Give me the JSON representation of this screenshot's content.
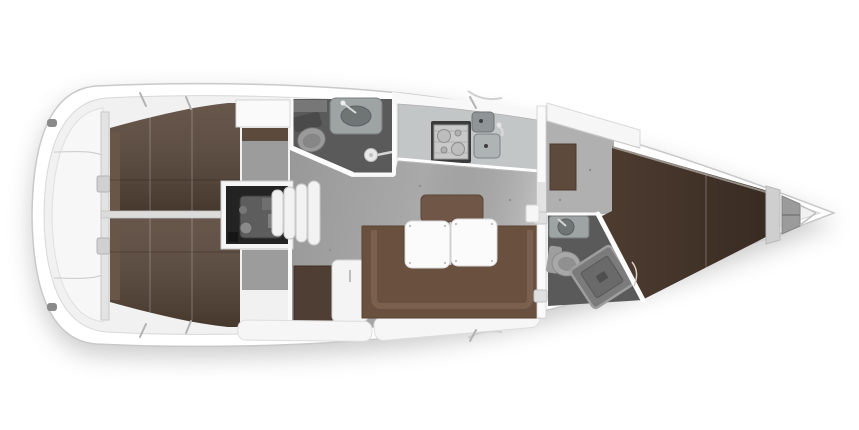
{
  "meta": {
    "type": "yacht-interior-floor-plan",
    "view": "top-down",
    "canvas": {
      "width": 859,
      "height": 430
    }
  },
  "parts": [
    "stern-lazarette",
    "aft-cabin-port-berth",
    "aft-cabin-starboard-berth",
    "engine-compartment",
    "companionway-steps",
    "wet-room-aft",
    "galley",
    "saloon-settee",
    "dinette-table",
    "nav-lockers",
    "forward-cabin",
    "forward-berth",
    "wet-room-forward",
    "anchor-locker"
  ],
  "colors": {
    "page_bg": "#ffffff",
    "hull": "#ffffff",
    "hull_line": "#c9c9c9",
    "deck": "#f1f1f1",
    "deck_line": "#d8d8d8",
    "lazarette": "#f7f7f7",
    "interior_floor": "#a9a9a9",
    "floor_light": "#bdbdbd",
    "berth": "#564437",
    "berth_forward": "#4e3c30",
    "headboard": "#6a5646",
    "cabin_locker": "#fafafa",
    "cabin_shelf": "#9c9c9c",
    "bulkhead": "#fafafa",
    "centerline_wall": "#dcdcdc",
    "engine_frame": "#f5f5f5",
    "engine_bay": "#232323",
    "engine_metal": "#5d5d5d",
    "step": "#f2f2f2",
    "heads_floor": "#5a5a5a",
    "fixture": "#9ea3a4",
    "fixture_dark": "#6f7475",
    "toilet_base": "#4a4a4a",
    "shower_tray": "#7b7b7b",
    "counter": "#c3c6c7",
    "stove": "#3b3b3b",
    "stove_top": "#c9c9c9",
    "sink": "#8f9496",
    "settee": "#69503f",
    "settee_trim": "#8a6e5b",
    "backrest": "#6f5646",
    "table": "#fbfbfb",
    "nav_locker": "#4f3e33",
    "anchor_locker": "#9b9b9b",
    "trim_white": "#f6f6f6"
  }
}
